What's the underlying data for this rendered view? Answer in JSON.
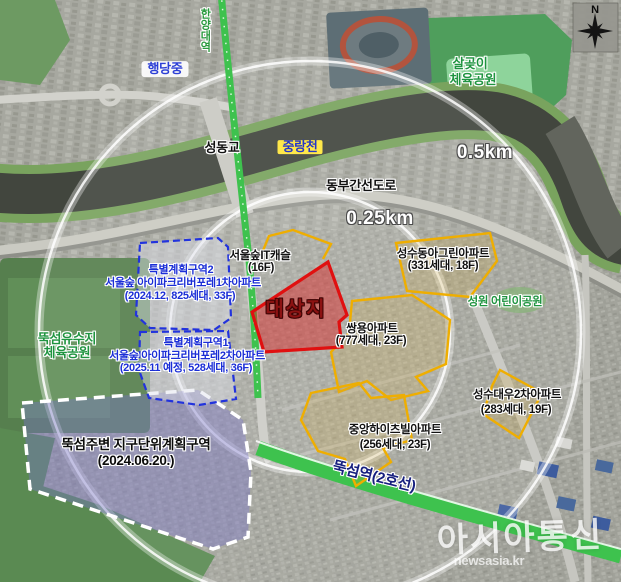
{
  "map": {
    "places": {
      "hangdang_school": "행당중",
      "seongdong_bridge": "성동교",
      "jungnang_stream": "중랑천",
      "dongbu_expressway": "동부간선도로",
      "salgoji_park_line1": "살곶이",
      "salgoji_park_line2": "체육공원",
      "seongwon_park": "성원 어린이공원",
      "yusuji_park_line1": "뚝섬유수지",
      "yusuji_park_line2": "체육공원",
      "hanyang_station": "한양대역",
      "ttukseom_station": "뚝섬역(2호선)"
    },
    "rings": {
      "inner": "0.25km",
      "outer": "0.5km"
    },
    "site": {
      "label": "대상지"
    },
    "special_zones": [
      {
        "title": "특별계획구역2",
        "name": "서울숲 아이파크리버포레1차아파트",
        "detail": "(2024.12, 825세대, 33F)"
      },
      {
        "title": "특별계획구역1",
        "name": "서울숲 아이파크리버포레2차아파트",
        "detail": "(2025.11 예정, 528세대, 36F)"
      }
    ],
    "district_zone": {
      "title": "뚝섬주변 지구단위계획구역",
      "detail": "(2024.06.20.)"
    },
    "apartments": [
      {
        "name": "서울숲IT캐슬",
        "detail": "(16F)"
      },
      {
        "name": "성수동아그린아파트",
        "detail": "(331세대, 18F)"
      },
      {
        "name": "쌍용아파트",
        "detail": "(777세대, 23F)"
      },
      {
        "name": "중앙하이츠빌아파트",
        "detail": "(256세대, 23F)"
      },
      {
        "name": "성수대우2차아파트",
        "detail": "(283세대, 19F)"
      }
    ],
    "compass": {
      "north": "N"
    },
    "watermark": {
      "brand": "아시아통신",
      "domain": "newsasia.kr"
    },
    "colors": {
      "site_outline": "#e01010",
      "apartment_outline": "#efae00",
      "special_zone_outline": "#2233dd",
      "district_fill": "#7a74c8",
      "subway_line_green": "#3ec24e",
      "ring_stroke": "#ffffff",
      "stream_label_bg": "#ffe84a"
    }
  }
}
